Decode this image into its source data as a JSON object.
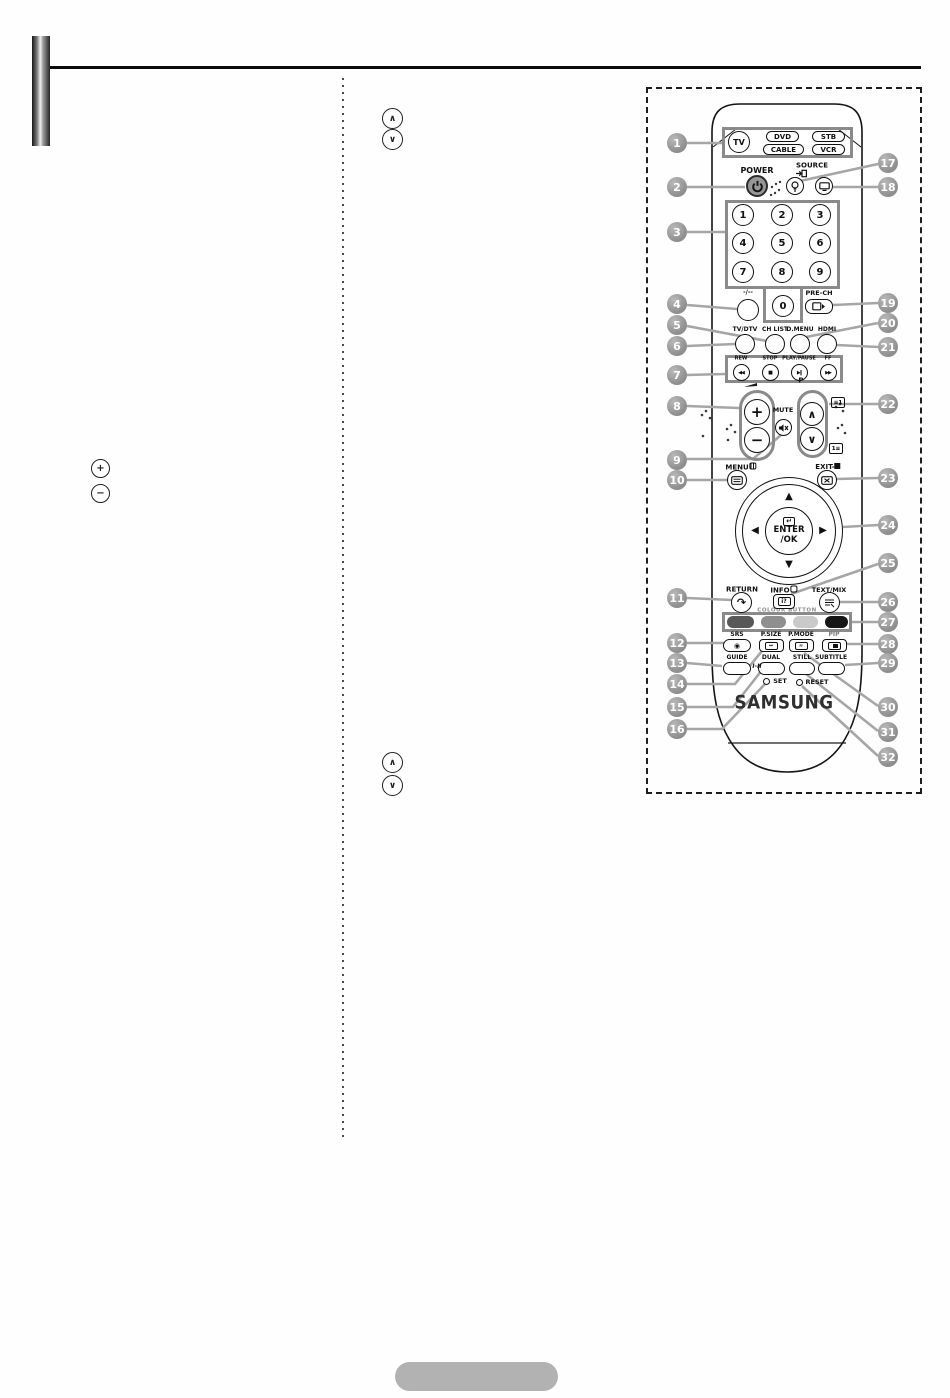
{
  "remote": {
    "brand": "SAMSUNG",
    "device_select": {
      "tv": "TV",
      "buttons": [
        "DVD",
        "STB",
        "CABLE",
        "VCR"
      ]
    },
    "power_label": "POWER",
    "source_label": "SOURCE",
    "digits": [
      "1",
      "2",
      "3",
      "4",
      "5",
      "6",
      "7",
      "8",
      "9"
    ],
    "zero": "0",
    "dash_label": "-/--",
    "pre_ch_label": "PRE-CH",
    "mode_row": [
      "TV/DTV",
      "CH LIST",
      "D.MENU",
      "HDMI"
    ],
    "transport": [
      "REW",
      "STOP",
      "PLAY/PAUSE",
      "FF"
    ],
    "volume_plus": "+",
    "volume_minus": "−",
    "channel_label": "P",
    "mute_label": "MUTE",
    "menu_label": "MENU",
    "exit_label": "EXIT-",
    "enter_line1": "ENTER",
    "enter_line2": "/OK",
    "return_label": "RETURN",
    "info_label": "INFO",
    "text_mix_label": "TEXT/MIX",
    "colour_button_text": "COLOUR BUTTON",
    "fn_row1": [
      "SRS",
      "P.SIZE",
      "P.MODE",
      "PIP"
    ],
    "fn_row2": [
      "GUIDE",
      "DUAL",
      "STILL",
      "SUBTITLE"
    ],
    "dual_icon_text": "I-II",
    "set_label": "SET",
    "reset_label": "RESET"
  },
  "callouts": {
    "left": [
      "1",
      "2",
      "3",
      "4",
      "5",
      "6",
      "7",
      "8",
      "9",
      "10",
      "11",
      "12",
      "13",
      "14",
      "15",
      "16"
    ],
    "right": [
      "17",
      "18",
      "19",
      "20",
      "21",
      "22",
      "23",
      "24",
      "25",
      "26",
      "27",
      "28",
      "29",
      "30",
      "31",
      "32"
    ]
  },
  "icons": {
    "list-up-icon": "∧",
    "list-down-icon": "∨",
    "plus-marker-icon": "+",
    "minus-marker-icon": "−",
    "rew-icon": "◀◀",
    "stop-icon": "■",
    "play-pause-icon": "▶‖",
    "ff-icon": "▶▶",
    "ch-up-icon": "∧",
    "ch-down-icon": "∨",
    "enter-icon": "↵",
    "return-icon": "↷",
    "srs-icon": "◉",
    "dpad-up-icon": "▲",
    "dpad-down-icon": "▼",
    "dpad-left-icon": "◀",
    "dpad-right-icon": "▶",
    "page-up-teletext-icon": "≡1",
    "page-index-teletext-icon": "1≡",
    "info-screen-icon": "i?",
    "p-size-icon": "↔",
    "p-mode-icon": "≈"
  },
  "colors": {
    "callout_gray": "#9c9c9c",
    "frame_gray": "#8a8a8a",
    "colour_buttons": [
      "#585858",
      "#8f8f8f",
      "#cacaca",
      "#151515"
    ],
    "badge_gray": "#b2b2b2"
  }
}
